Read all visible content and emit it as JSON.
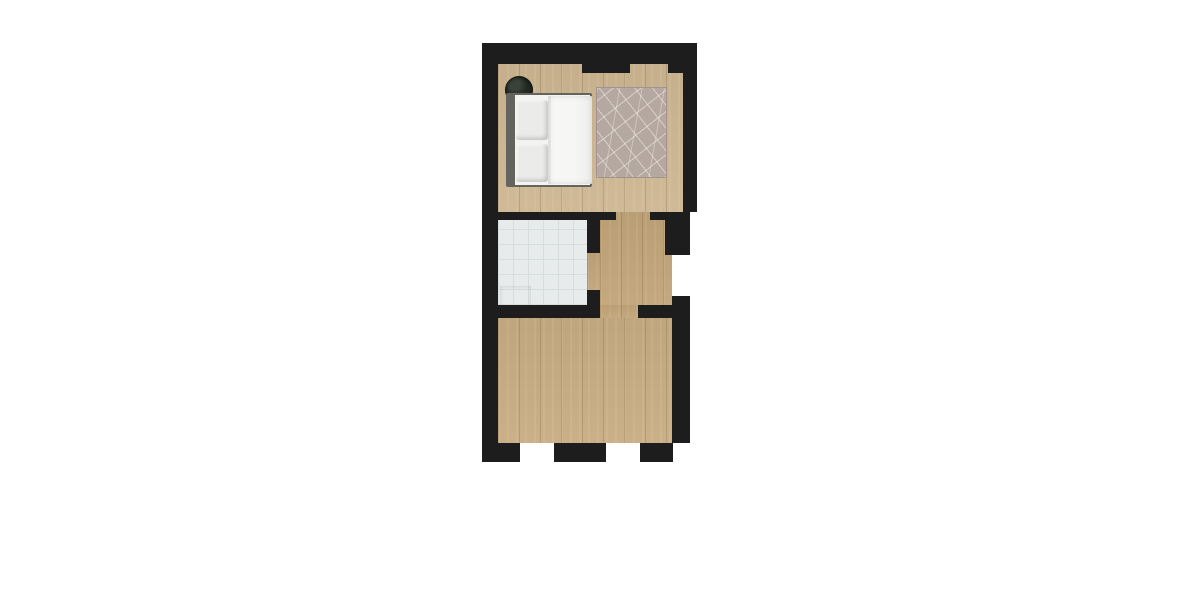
{
  "meta": {
    "type": "3d-rendered-floor-plan",
    "view": "top-down",
    "canvas": {
      "width": 1200,
      "height": 600
    }
  },
  "palette": {
    "wall": "#1d1d1d",
    "wood_bedroom": "#cdb691",
    "wood_hall": "#c1a478",
    "wood_living": "#c7ac82",
    "tile": "#e8ebeb",
    "tile_line": "#d7dcdc",
    "rug": "#b5a8a1",
    "linen": "#f3f3f1",
    "bed_frame": "#64635e",
    "pillow": "#ebebe9",
    "plant": "#222921",
    "wardrobe": "#6f452c",
    "wardrobe_drawer": "#c18a66",
    "wardrobe_drawer2": "#b37c58",
    "rack": "#5e3b25",
    "fixture": "#f8f8f6",
    "fixture_line": "#c4c8c9",
    "tub": "#e2e6e7",
    "tub_inner": "#ccd3d5",
    "sofa": "#b2b0a7",
    "sofa_back": "#a3a198",
    "cushion": "#9b9da1",
    "marble": "#f1eee8",
    "cooktop": "#2b2b2b",
    "steel": "#ced3d2",
    "deck_frame": "#d8d7d3",
    "deck_a": "#8a5427",
    "deck_b": "#7b4a21",
    "deck_seam": "#33200e",
    "mat": "#27451f",
    "sill": "#efede9",
    "sill_inner": "#e2dfd8",
    "leaf": "#f5f5f3",
    "threshold": "#eceae6"
  },
  "plan": {
    "rooms": [
      {
        "name": "bedroom",
        "floor": "light-oak-wood",
        "windows": 2,
        "furniture": [
          "double-bed",
          "two-pillows",
          "potted-plant",
          "patterned-area-rug",
          "open-wardrobe",
          "clothes-rack",
          "side-stool"
        ]
      },
      {
        "name": "bathroom",
        "floor": "grey-tile",
        "furniture": [
          "bathtub",
          "toilet",
          "washing-machine",
          "sink-vanity"
        ],
        "doors": [
          "swing-door-to-hallway"
        ]
      },
      {
        "name": "hallway",
        "floor": "oak-wood",
        "doors": [
          "bedroom-door",
          "entry-door-with-threshold",
          "living-room-door"
        ]
      },
      {
        "name": "living-room-kitchen",
        "floor": "oak-wood",
        "furniture": [
          "three-seat-sofa",
          "four-cushions",
          "round-marble-dining-table",
          "four-dining-chairs",
          "white-console-bench",
          "kitchen-counter",
          "four-burner-cooktop",
          "kitchen-sink"
        ],
        "doors": [
          "door-to-deck"
        ],
        "windows": 1
      },
      {
        "name": "deck",
        "floor": "hardwood-planks",
        "furniture": [
          "corner-posts",
          "two-green-doormats"
        ],
        "exterior": [
          "stair-structure"
        ]
      }
    ]
  }
}
